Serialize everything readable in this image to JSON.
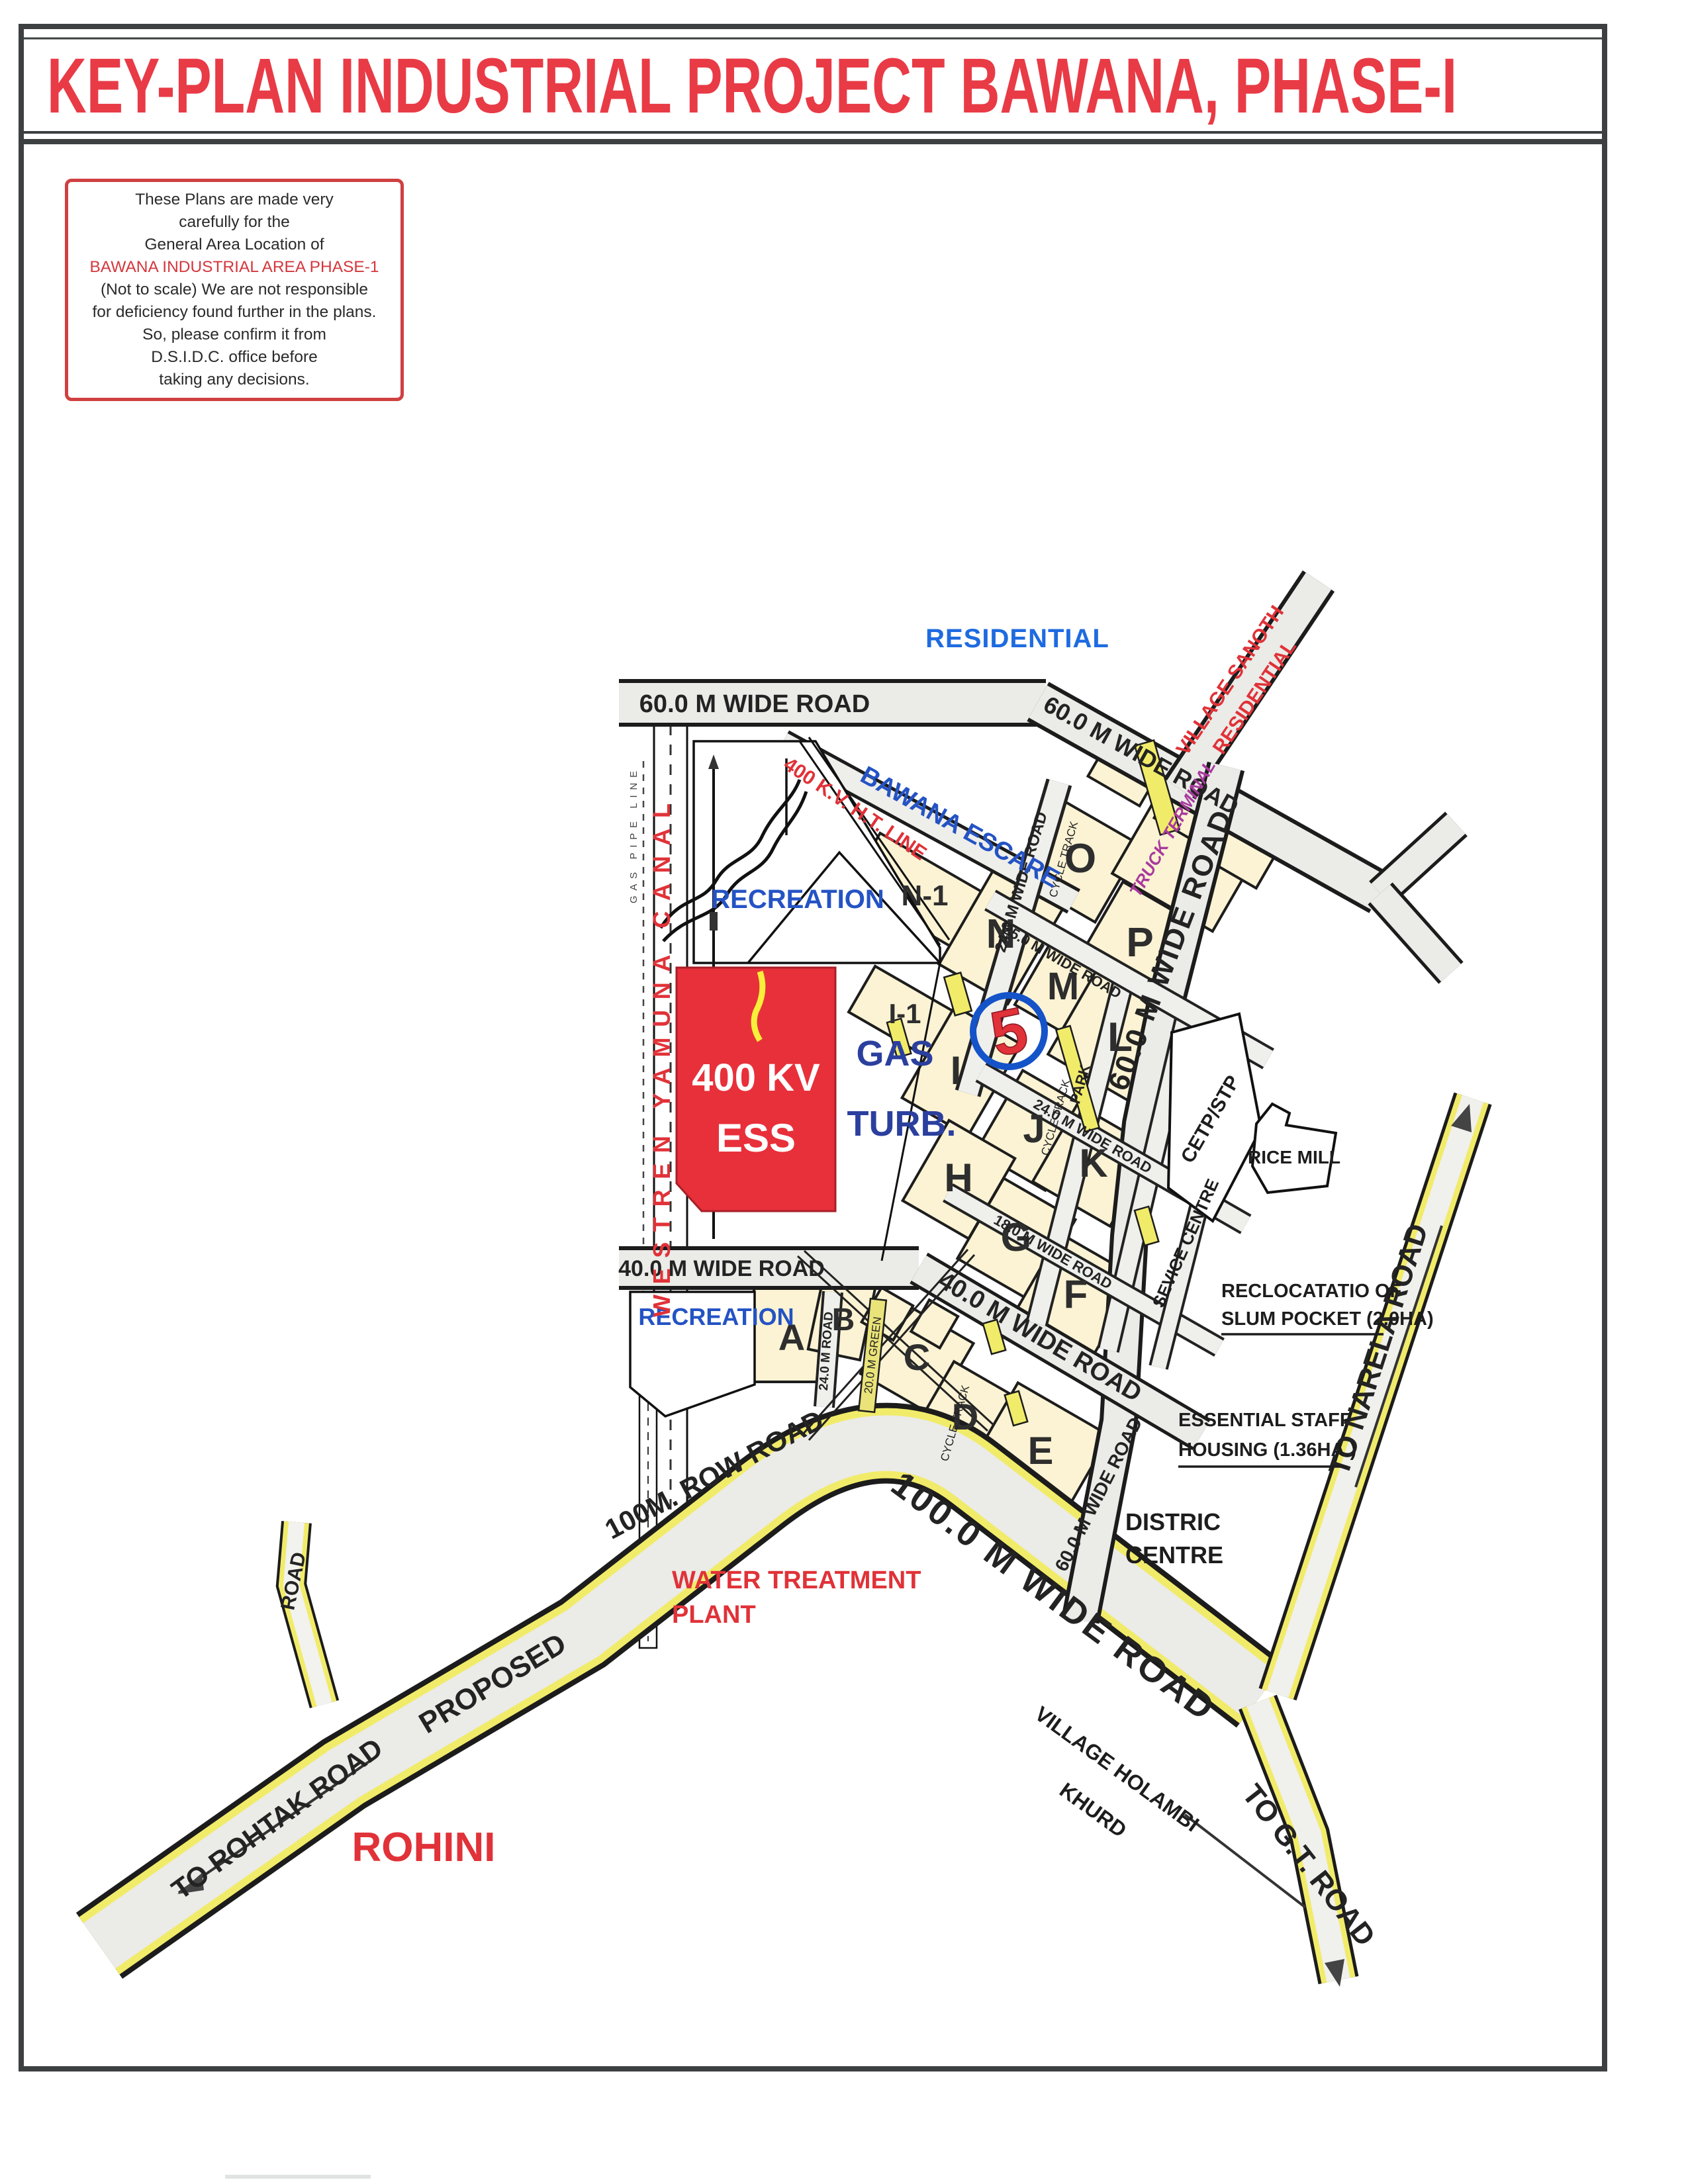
{
  "title": "KEY-PLAN INDUSTRIAL PROJECT BAWANA, PHASE-I",
  "disclaimer": {
    "line1": "These Plans are made very",
    "line2": "carefully for the",
    "line3": "General Area Location of",
    "highlight": "BAWANA INDUSTRIAL AREA PHASE-1",
    "line4": "(Not to scale) We are not responsible",
    "line5": "for deficiency found further in the plans.",
    "line6": "So, please confirm it from",
    "line7": "D.S.I.D.C. office before",
    "line8": "taking any decisions."
  },
  "colors": {
    "title_red": "#e83b46",
    "map_red": "#e03238",
    "map_blue": "#2453c4",
    "bright_blue": "#1e6be0",
    "purple": "#a93a9e",
    "cream": "#fbf3d3",
    "road_gray": "#ebebe8",
    "road_yellow": "#f1eb6a",
    "frame_dark": "#3c4040",
    "ess_red": "#e8303a",
    "marker_blue": "#1553c9"
  },
  "map": {
    "marker": {
      "value": "5"
    },
    "sectors": [
      "N-1",
      "N",
      "O",
      "P",
      "M",
      "L",
      "I-1",
      "I",
      "J",
      "K",
      "H",
      "G",
      "F",
      "A",
      "B",
      "C",
      "D",
      "E"
    ],
    "roads": {
      "r60": "60.0 M WIDE ROAD",
      "r40": "40.0 M WIDE ROAD",
      "r25": "25.0 M WIDE ROAD",
      "r24": "24.0 M WIDE ROAD",
      "r24s": "24.0 M ROAD",
      "r18": "18.0 M WIDE ROAD",
      "r100row": "100M. ROW ROAD",
      "r100wide": "100.0 M WIDE ROAD",
      "cycle": "CYCLE TRACK",
      "green20": "20.0 M GREEN",
      "park": "PARK",
      "proposed": "PROPOSED",
      "road_branch": "ROAD",
      "to_rohtak": "TO ROHTAK ROAD",
      "to_gt": "TO G.T. ROAD",
      "to_narela": "TO NARELA ROAD"
    },
    "labels": {
      "residential": "RESIDENTIAL",
      "village_sanoth_1": "VILLAGE SANOTH",
      "village_sanoth_2": "RESIDENTIAL",
      "bawana_escare": "BAWANA ESCARE",
      "ht_line": "400 K.V. H.T. LINE",
      "recreation": "RECREATION",
      "canal": "WESTREN YAMUNA CANAL",
      "gas_pipe": "GAS PIPE LINE",
      "ess_1": "400 KV",
      "ess_2": "ESS",
      "gas_turb_1": "GAS",
      "gas_turb_2": "TURB.",
      "truck_terminal": "TRUCK TERMINAL",
      "cetp": "CETP/STP",
      "rice_mill": "RICE MILL",
      "sevice_centre": "SEVICE CENTRE",
      "relocation_1": "RECLOCATATIO OF",
      "relocation_2": "SLUM POCKET (2.0HA)",
      "staff_1": "ESSENTIAL STAFF",
      "staff_2": "HOUSING (1.36HA.)",
      "district_1": "DISTRIC",
      "district_2": "CENTRE",
      "wtp_1": "WATER TREATMENT",
      "wtp_2": "PLANT",
      "holambi_1": "VILLAGE HOLAMBI",
      "holambi_2": "KHURD",
      "rohini": "ROHINI"
    }
  }
}
